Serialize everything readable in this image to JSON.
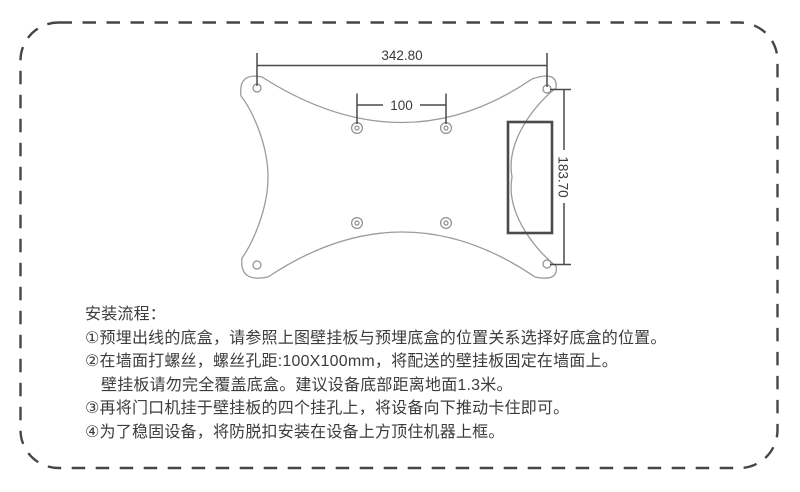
{
  "diagram": {
    "dim_width": "342.80",
    "dim_hole_spacing": "100",
    "dim_height": "183.70",
    "colors": {
      "plate_outline": "#9b9b9b",
      "dimension_line": "#4a4a4e",
      "page_border": "#46464a",
      "text": "#3a3a3a"
    }
  },
  "instructions": {
    "title": "安装流程：",
    "steps": [
      "①预埋出线的底盒，请参照上图壁挂板与预埋底盒的位置关系选择好底盒的位置。",
      "②在墙面打螺丝，螺丝孔距:100X100mm，将配送的壁挂板固定在墙面上。",
      "壁挂板请勿完全覆盖底盒。建议设备底部距离地面1.3米。",
      "③再将门口机挂于壁挂板的四个挂孔上，将设备向下推动卡住即可。",
      "④为了稳固设备，将防脱扣安装在设备上方顶住机器上框。"
    ]
  }
}
